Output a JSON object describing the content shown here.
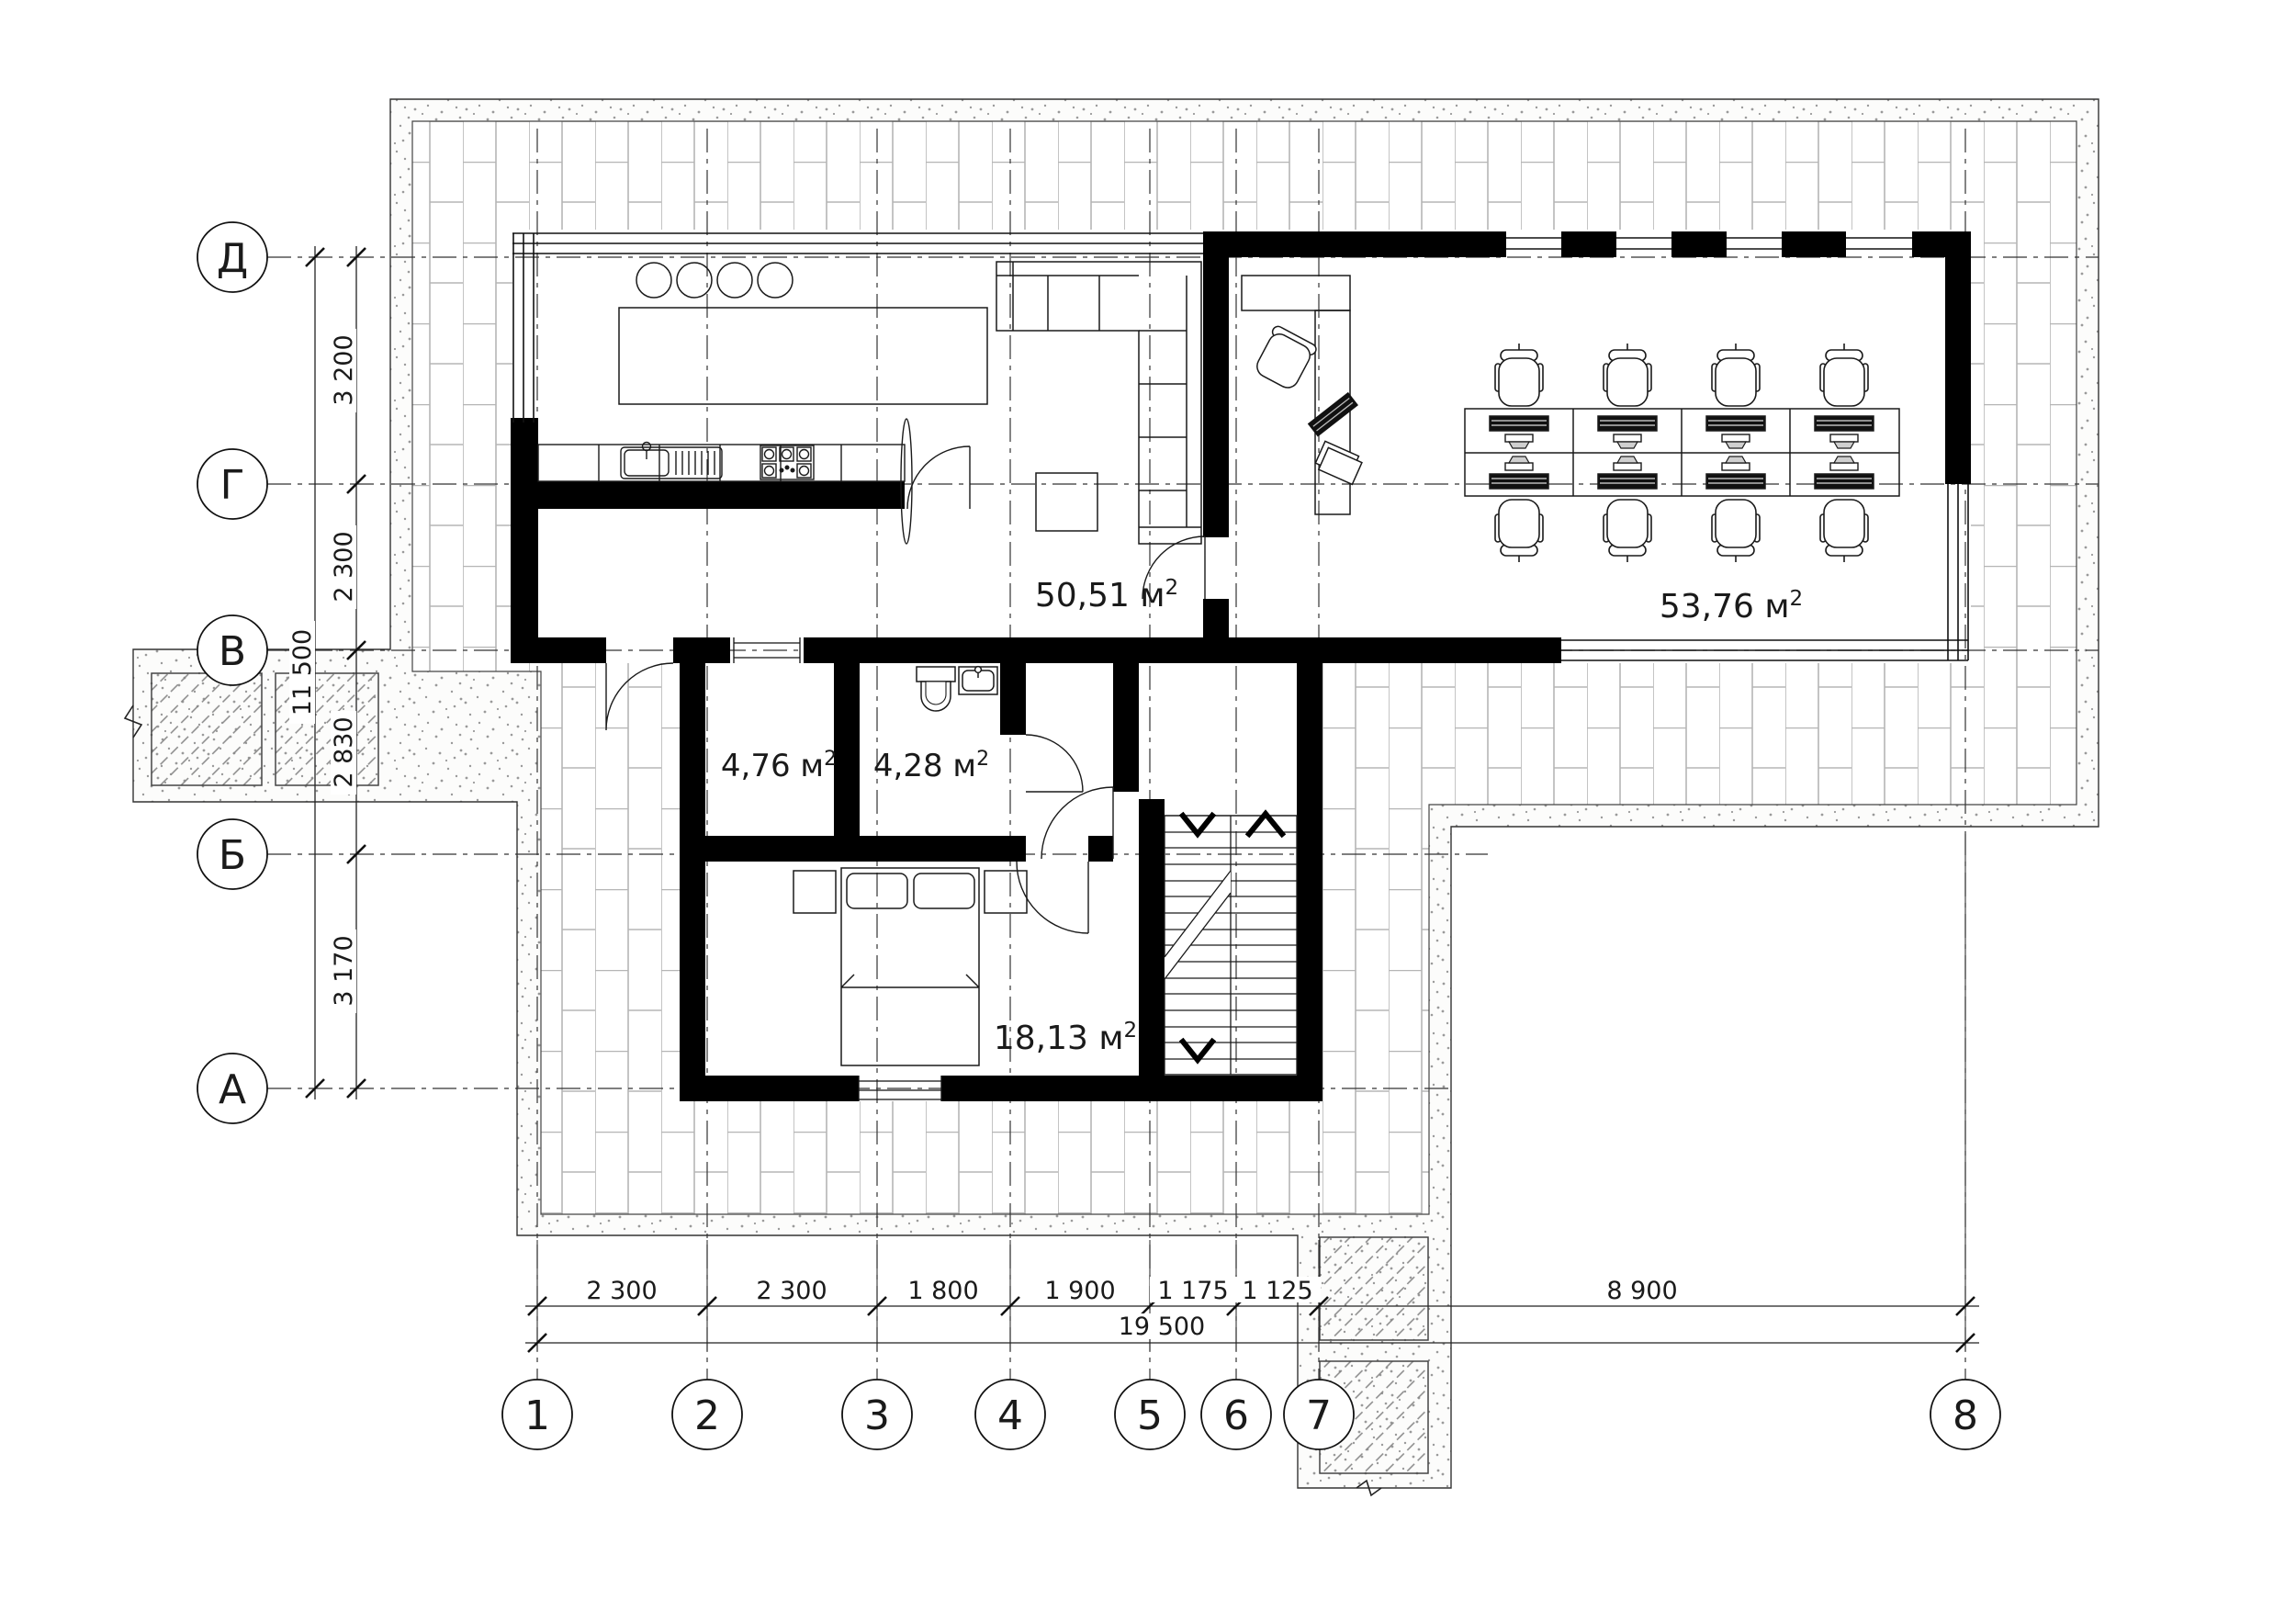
{
  "colors": {
    "background": "#ffffff",
    "wall": "#000000",
    "line": "#1a1a1a",
    "paving_line": "#b5b5b5",
    "stipple_dot": "#9a9a9a",
    "hatch_line": "#888888"
  },
  "axis_circles": {
    "rows": [
      "Д",
      "Г",
      "В",
      "Б",
      "А"
    ],
    "cols": [
      "1",
      "2",
      "3",
      "4",
      "5",
      "6",
      "7",
      "8"
    ]
  },
  "dimensions": {
    "left_segments": [
      "3 200",
      "2 300",
      "2 830",
      "3 170"
    ],
    "left_total": "11 500",
    "bottom_segments": [
      "2 300",
      "2 300",
      "1 800",
      "1 900",
      "1 175",
      "1 125",
      "8 900"
    ],
    "bottom_total": "19 500"
  },
  "rooms": {
    "living_kitchen": {
      "area_value": "50,51 м"
    },
    "studio": {
      "area_value": "53,76 м"
    },
    "storage": {
      "area_value": "4,76 м"
    },
    "bathroom": {
      "area_value": "4,28 м"
    },
    "bedroom": {
      "area_value": "18,13 м"
    }
  },
  "superscript": "2"
}
